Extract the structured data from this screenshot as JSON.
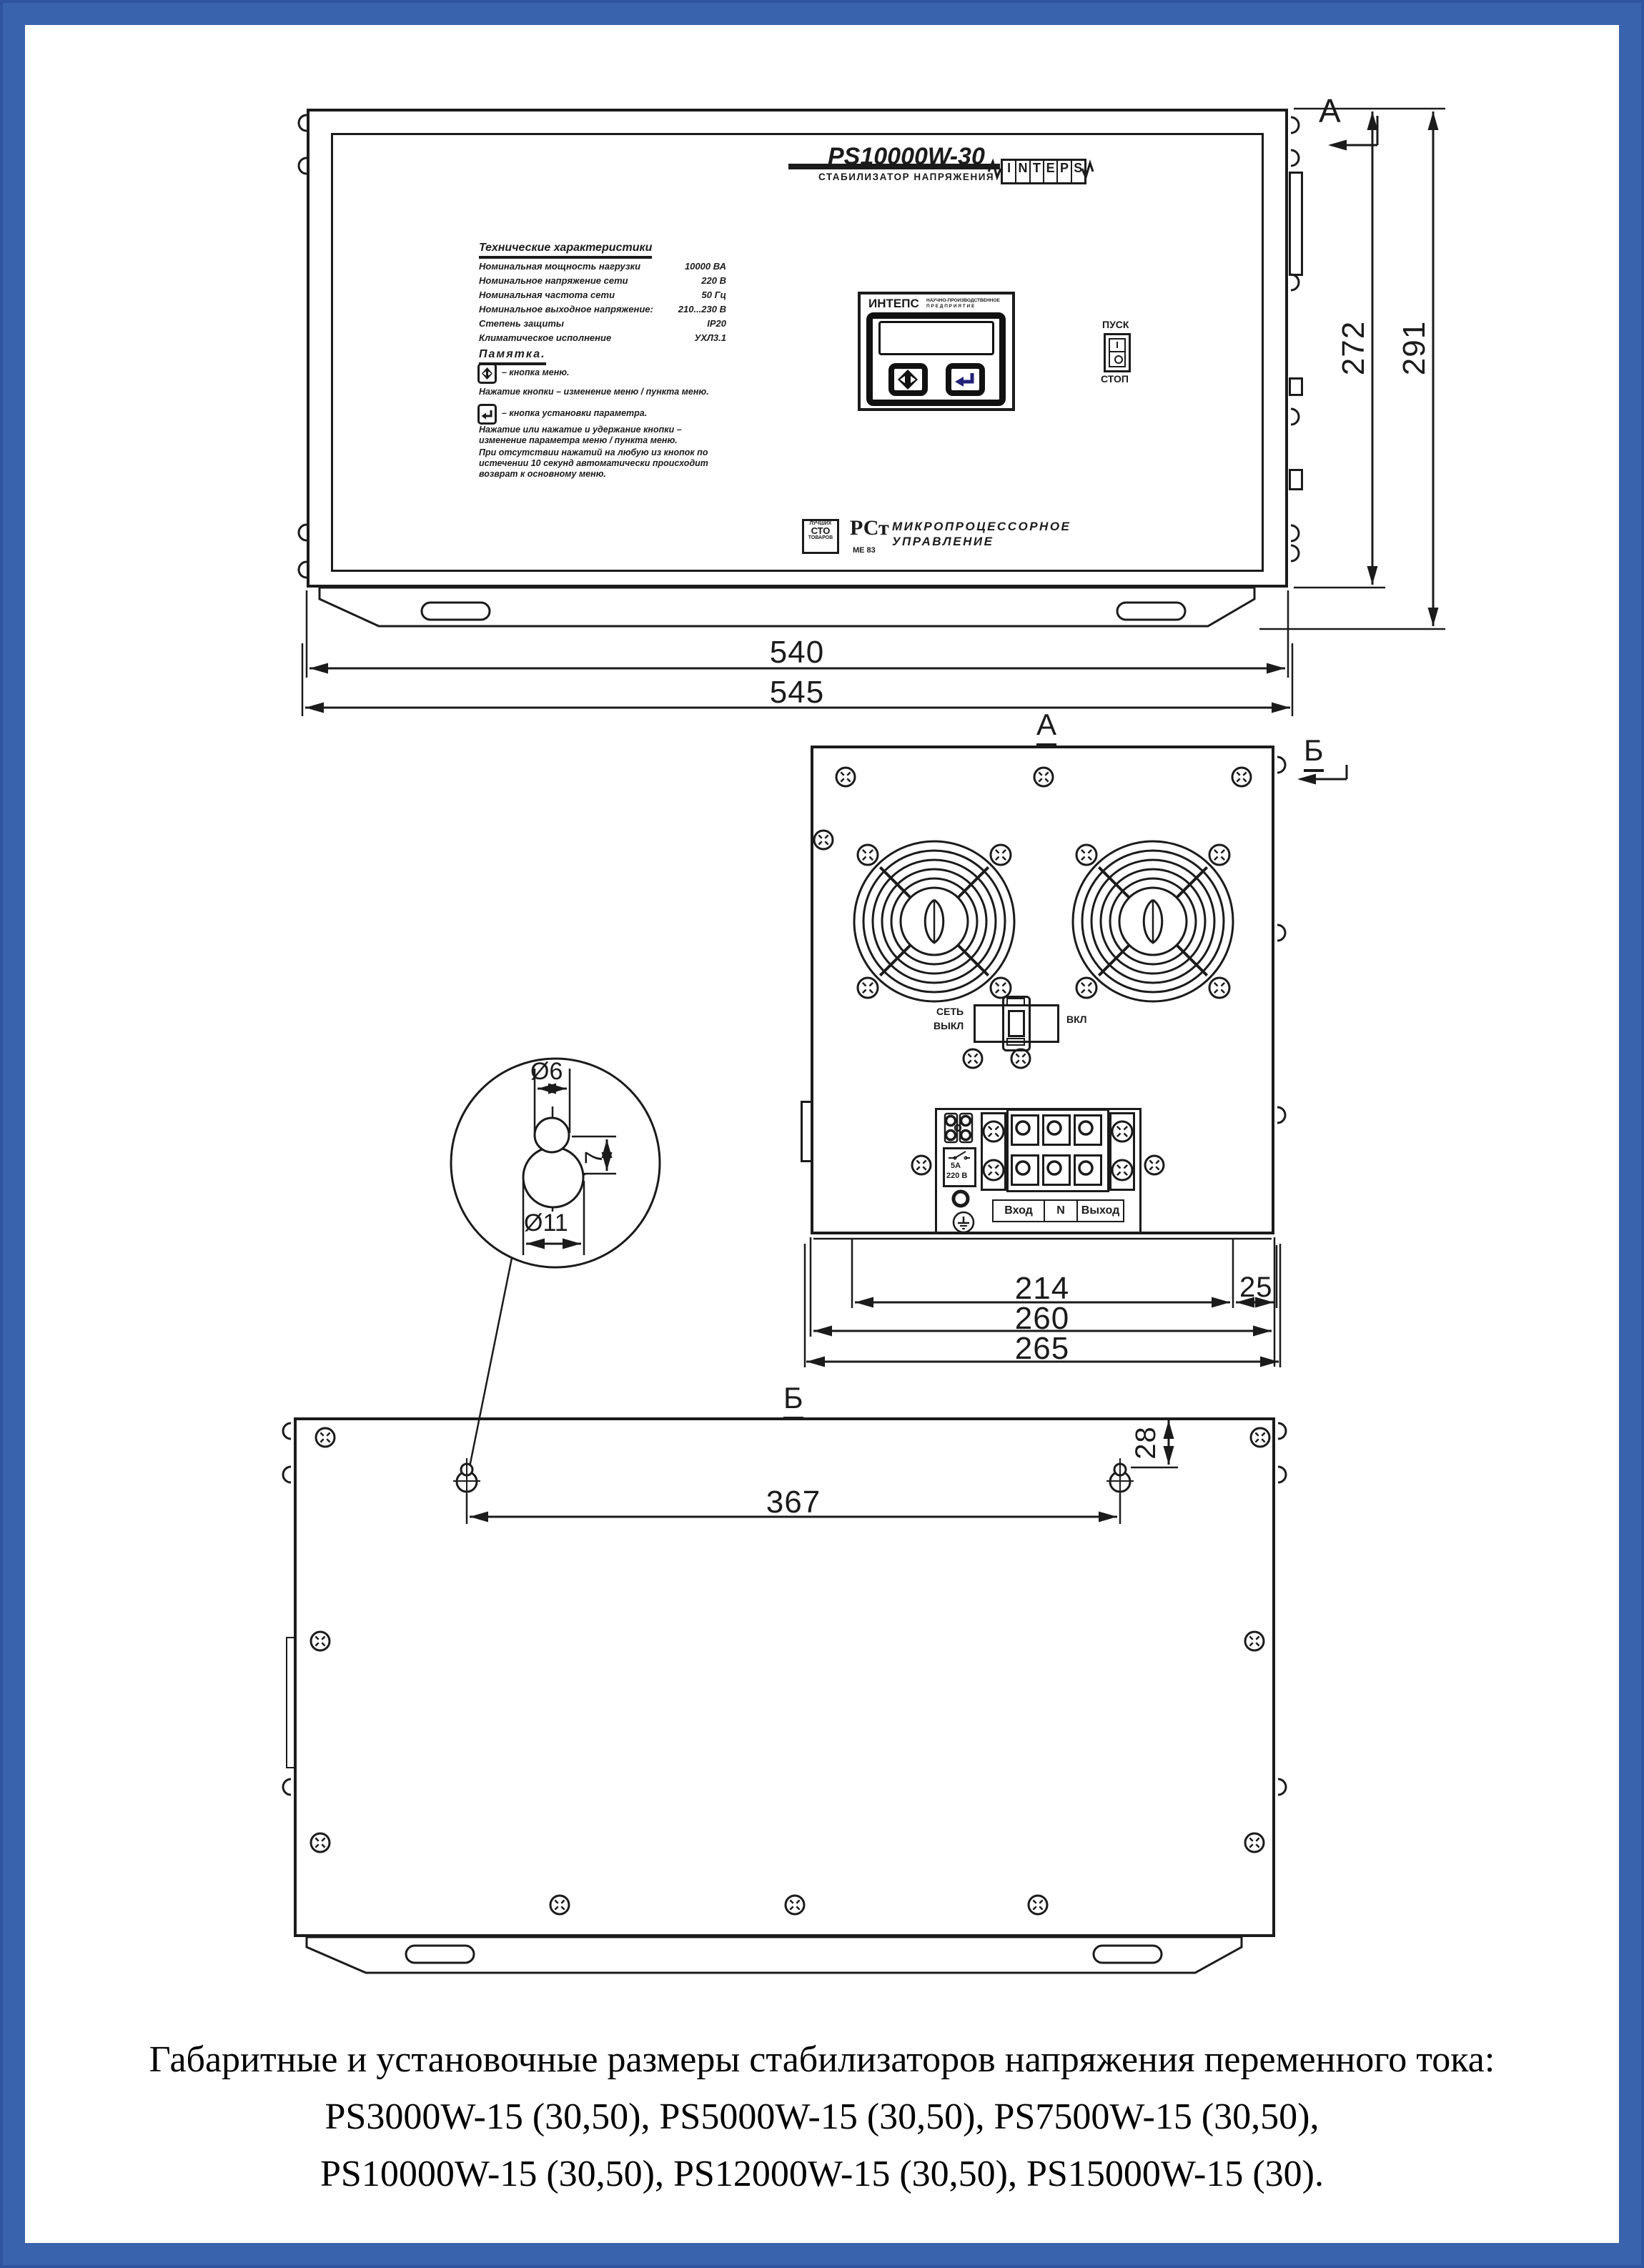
{
  "front": {
    "model": "PS10000W-30",
    "type_label": "СТАБИЛИЗАТОР НАПРЯЖЕНИЯ",
    "logo": {
      "l0": "I",
      "l1": "N",
      "l2": "T",
      "l3": "E",
      "l4": "P",
      "l5": "S"
    },
    "specs_title": "Технические характеристики",
    "specs": [
      {
        "label": "Номинальная мощность нагрузки",
        "value": "10000 ВА"
      },
      {
        "label": "Номинальное напряжение сети",
        "value": "220 В"
      },
      {
        "label": "Номинальная частота сети",
        "value": "50 Гц"
      },
      {
        "label": "Номинальное выходное напряжение:",
        "value": "210...230 В"
      },
      {
        "label": "Степень защиты",
        "value": "IP20"
      },
      {
        "label": "Климатическое исполнение",
        "value": "УХЛ3.1"
      }
    ],
    "memo_title": "Памятка.",
    "memo_item1": "–  кнопка  меню.",
    "memo_note1": "Нажатие  кнопки  –  изменение  меню  /  пункта  меню.",
    "memo_item2": "–  кнопка  установки  параметра.",
    "memo_note2": "Нажатие или нажатие и удержание кнопки – изменение параметра меню / пункта меню.",
    "memo_note3": "При отсутствии нажатий на любую из кнопок по истечении 10 секунд автоматически происходит возврат к основному меню.",
    "display_brand": "ИНТЕПС",
    "display_sub1": "НАУЧНО-ПРОИЗВОДСТВЕННОЕ",
    "display_sub2": "П Р Е Д П Р И Я Т И Е",
    "btn_start": "ПУСК",
    "btn_stop": "СТОП",
    "badge_top": "ЛУЧШИХ",
    "badge_mid": "СТО",
    "badge_bottom": "ТОВАРОВ",
    "cert_mark": "РСт",
    "cert_code": "МЕ 83",
    "feature1": "МИКРОПРОЦЕССОРНОЕ",
    "feature2": "УПРАВЛЕНИЕ"
  },
  "top_view": {
    "view_label": "А",
    "section_label": "Б",
    "mains1": "СЕТЬ",
    "mains2": "ВЫКЛ",
    "mains_on": "ВКЛ",
    "relay_amp": "5А",
    "relay_volt": "220 В",
    "terminals": [
      {
        "t": "Вход"
      },
      {
        "t": "N"
      },
      {
        "t": "Выход"
      }
    ]
  },
  "bottom_view": {
    "view_label": "Б"
  },
  "section_a": "А",
  "detail": {
    "top_dia": "Ø6",
    "depth": "7",
    "bottom_dia": "Ø11"
  },
  "dims": {
    "d540": "540",
    "d545": "545",
    "d272": "272",
    "d291": "291",
    "d214": "214",
    "d25": "25",
    "d260": "260",
    "d265": "265",
    "d367": "367",
    "d28": "28"
  },
  "caption": {
    "line1": "Габаритные и установочные размеры стабилизаторов напряжения переменного тока:",
    "line2": "PS3000W-15 (30,50), PS5000W-15 (30,50), PS7500W-15 (30,50),",
    "line3": "PS10000W-15 (30,50), PS12000W-15 (30,50), PS15000W-15 (30)."
  }
}
